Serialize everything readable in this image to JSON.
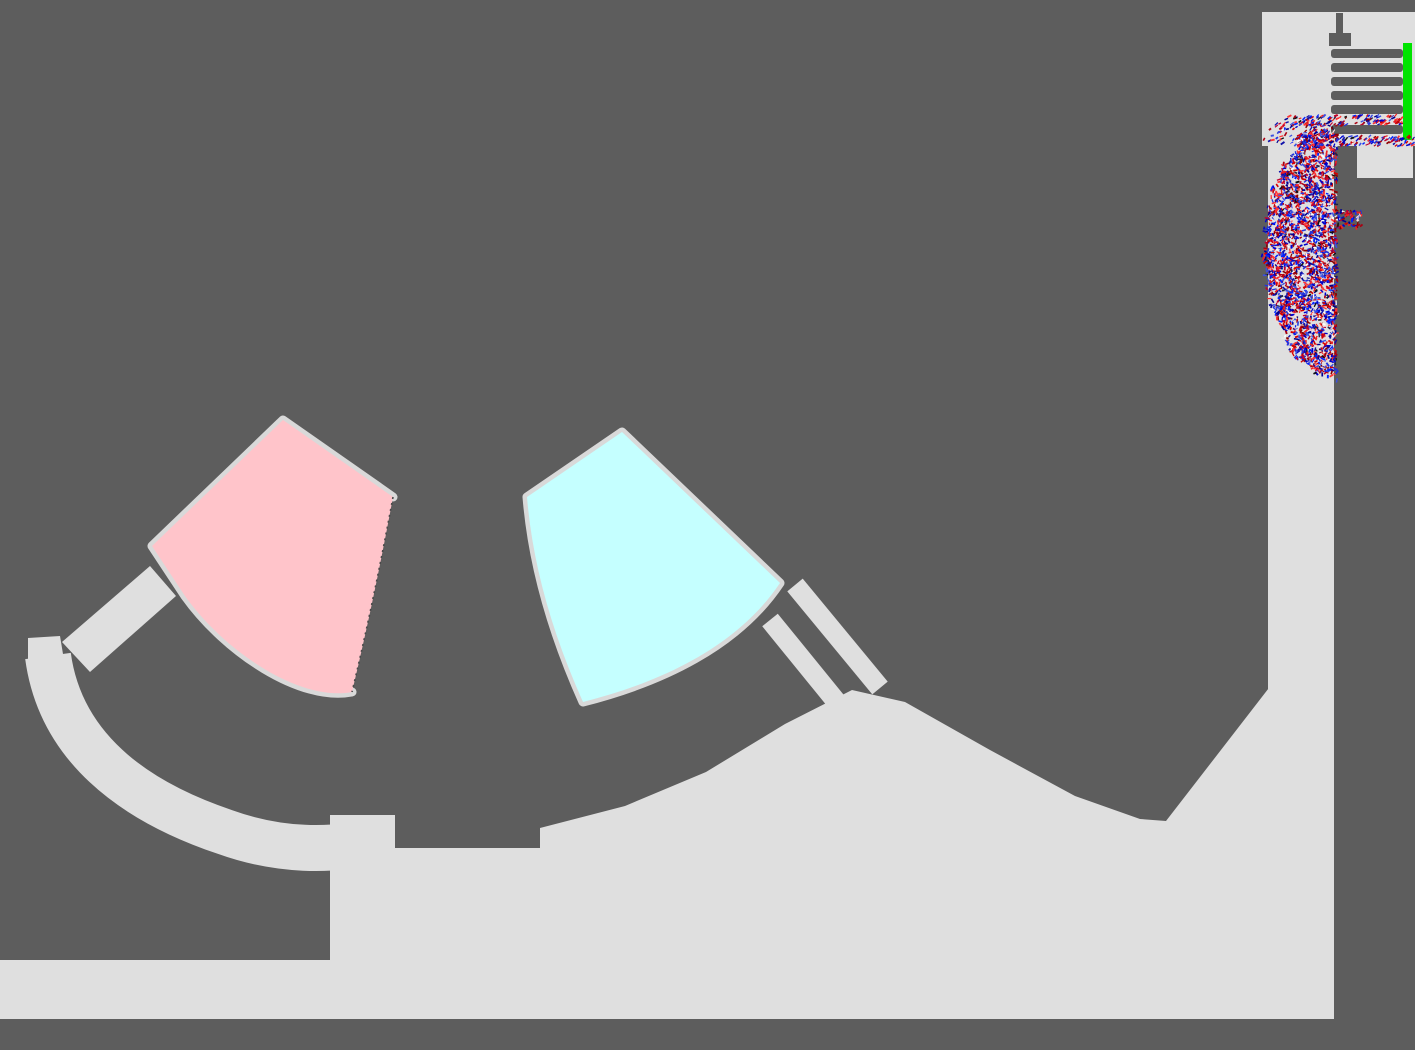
{
  "scene": {
    "kind": "2d-particle-physics-simulation",
    "colors": {
      "background": "#5d5d5d",
      "terrain": "#dfdfdf",
      "bin_wall": "#d9d9d9",
      "pink_bin_fill": "#ffc4ca",
      "cyan_bin_fill": "#c5ffff",
      "gate_green": "#00e400",
      "bar_dark": "#5d5d5d",
      "edge_dots": "#4a4a4a",
      "particle_reds": [
        "#d40000",
        "#aa0011",
        "#ee2222",
        "#8b0000",
        "#ff3333",
        "#c00030"
      ],
      "particle_blues": [
        "#0000cc",
        "#2233dd",
        "#000090",
        "#3b4fe0",
        "#1111aa",
        "#0022ff"
      ],
      "particle_lights": [
        "#ffffff",
        "#e8e8e8",
        "#f4d9d9"
      ],
      "particle_darks": [
        "#101010",
        "#222244"
      ]
    },
    "comb": {
      "bar_x": 1331,
      "bar_w": 72,
      "bar_h": 9,
      "bar_ys": [
        49,
        63,
        77,
        91,
        105,
        125
      ]
    },
    "gate": {
      "x": 1403,
      "y": 43,
      "w": 9,
      "h": 97
    },
    "particles": {
      "seed": 1337,
      "dash_len_min": 2.5,
      "dash_len_max": 4.6,
      "dash_w_min": 1.1,
      "dash_w_max": 1.9,
      "blob": {
        "cx": 1337,
        "cy": 252,
        "rx": 73,
        "ry": 126,
        "count": 2600
      },
      "spill": {
        "cx": 1296,
        "cy": 134,
        "rx": 36,
        "ry": 13,
        "count": 90
      },
      "stream_top": {
        "x1": 1284,
        "y1": 121,
        "x2": 1402,
        "y2": 120,
        "thickness": 10,
        "count": 150
      },
      "stream_bottom": {
        "x1": 1296,
        "y1": 140,
        "x2": 1414,
        "y2": 141,
        "thickness": 10,
        "count": 160
      },
      "ledge": {
        "x": 1337,
        "y": 211,
        "w": 25,
        "h": 17,
        "count": 70
      }
    }
  }
}
